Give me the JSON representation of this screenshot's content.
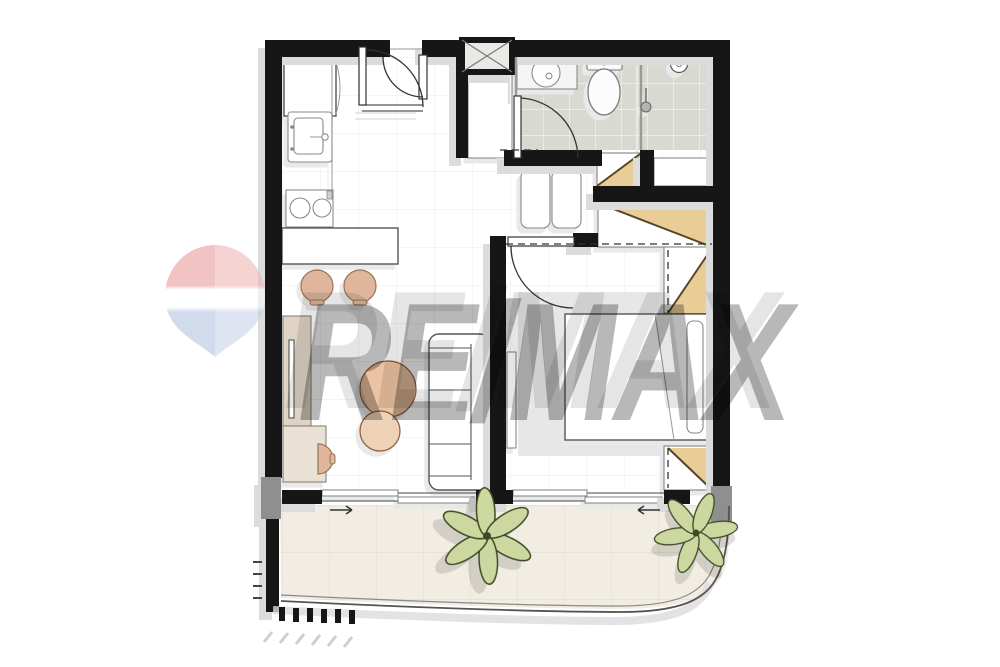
{
  "watermark": {
    "text": "RE/MAX"
  },
  "colors": {
    "wall": "#161616",
    "pillar": "#8f8f8f",
    "shadow": "#dcdcdc",
    "grid": "#ebebeb",
    "tile": "#d8d9d1",
    "tileLine": "#f2f2ee",
    "balcony": "#f2ede3",
    "balconyLine": "#e3dccd",
    "wood": "#e9cd96",
    "woodLine": "#5a4426",
    "stool": "#dfb69c",
    "tableBig": "#ecc3a2",
    "tableSmall": "#eed2b8",
    "beigeA": "#ded3c4",
    "beigeB": "#e9e1d3",
    "rug": "#e7e7e7",
    "plant": "#ccd8a0",
    "plantLine": "#3c4a26",
    "outline": "#555555",
    "ballRed": "#d95353",
    "ballBlue": "#8099cc",
    "mark": "rgba(0,0,0,0.28)",
    "markEcho": "rgba(0,0,0,0.10)"
  }
}
